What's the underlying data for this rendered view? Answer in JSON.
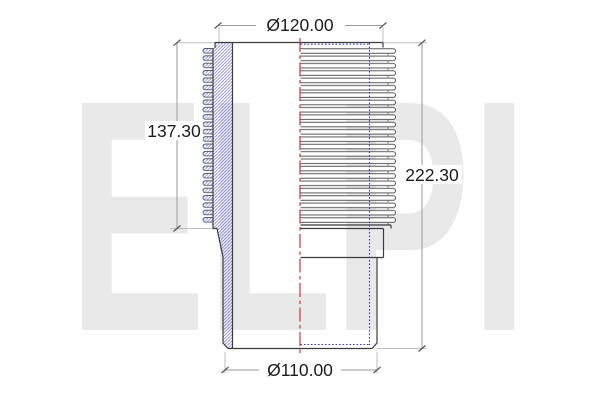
{
  "drawing": {
    "kind": "finned-cylinder-liner-half-section",
    "watermark": {
      "text": "ELPI"
    },
    "dimensions": {
      "top_diameter": {
        "label": "Ø120.00"
      },
      "fin_section_height": {
        "label": "137.30"
      },
      "total_height": {
        "label": "222.30"
      },
      "bottom_diameter": {
        "label": "Ø110.00"
      }
    },
    "colors": {
      "outline": "#3c3c3c",
      "dimension_line": "#9a9a9a",
      "extension_line": "#bdbdbd",
      "section_hatch": "#7a7ad2",
      "hidden_line_blue": "#3c3cb8",
      "centerline_red": "#cc2233",
      "watermark_gray": "#e9e9e9",
      "text": "#1c1c1c"
    }
  }
}
